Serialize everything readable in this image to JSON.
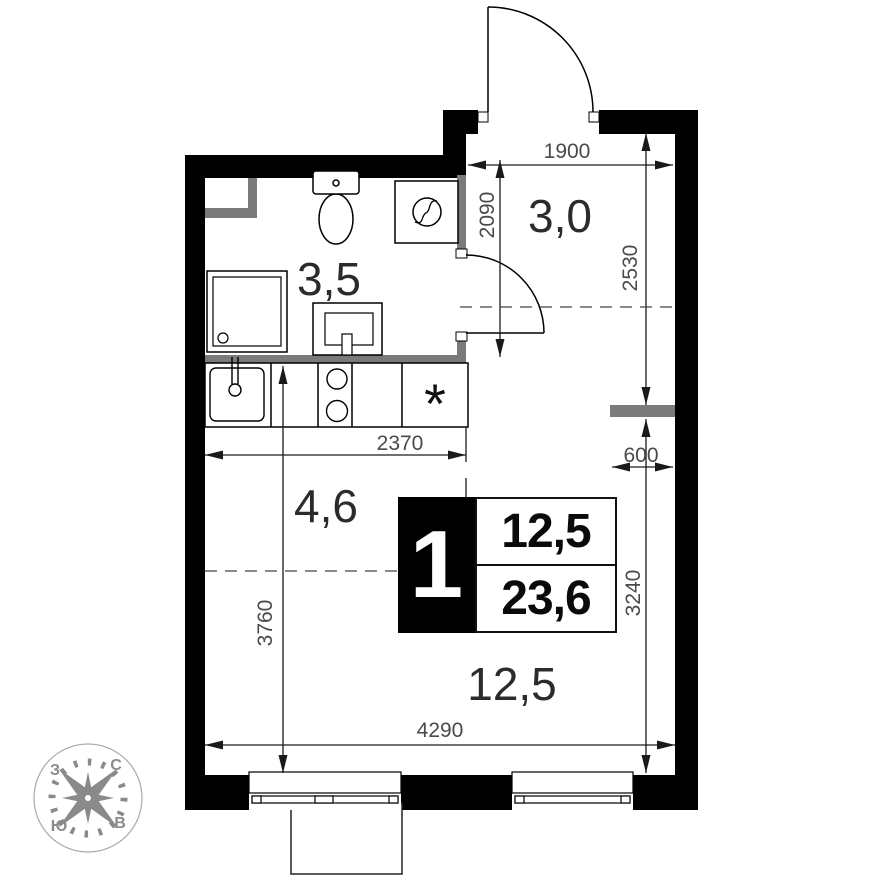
{
  "rooms": {
    "bathroom": {
      "area": "3,5"
    },
    "hallway": {
      "area": "3,0"
    },
    "kitchen": {
      "area": "4,6"
    },
    "living_room": {
      "area": "12,5"
    }
  },
  "unit_info": {
    "room_count": "1",
    "living_area": "12,5",
    "total_area": "23,6"
  },
  "dimensions": {
    "entry_width": "1900",
    "hall_depth": "2090",
    "hall_length": "2530",
    "stub_width": "600",
    "kitchen_width": "2370",
    "living_depth": "3760",
    "living_right_depth": "3240",
    "living_width": "4290"
  },
  "compass": {
    "west": "З",
    "north": "С",
    "south": "Ю",
    "east": "В"
  },
  "icons": {
    "fridge": "*"
  },
  "colors": {
    "wall": "#000000",
    "partition": "#7a7a7a",
    "dimension_text": "#4a4a4a",
    "compass": "#8a8a8a"
  }
}
